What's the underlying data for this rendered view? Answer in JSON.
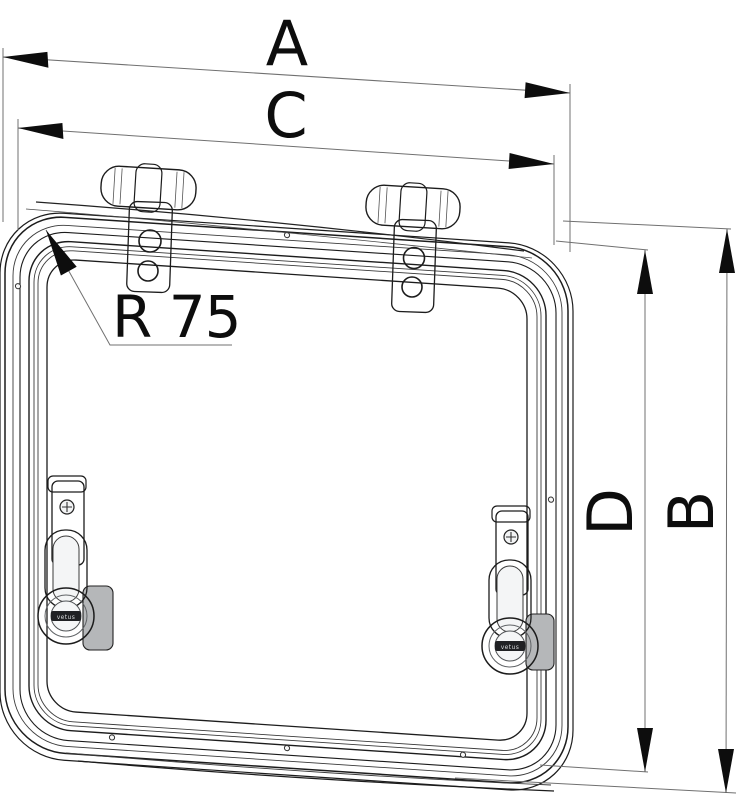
{
  "drawing": {
    "labels": {
      "dim_a": "A",
      "dim_b": "B",
      "dim_c": "C",
      "dim_d": "D",
      "radius": "R 75"
    },
    "latch_brand_text": "vetus",
    "colors": {
      "outline": "#1c1c1c",
      "dim_line": "#707070",
      "label_text": "#0d0d0d",
      "metal_light": "#f2f3f4",
      "metal_mid": "#d9dadc",
      "metal_dark": "#9fa2a5",
      "glass_shade": "#d7d8da",
      "background": "#ffffff"
    }
  }
}
